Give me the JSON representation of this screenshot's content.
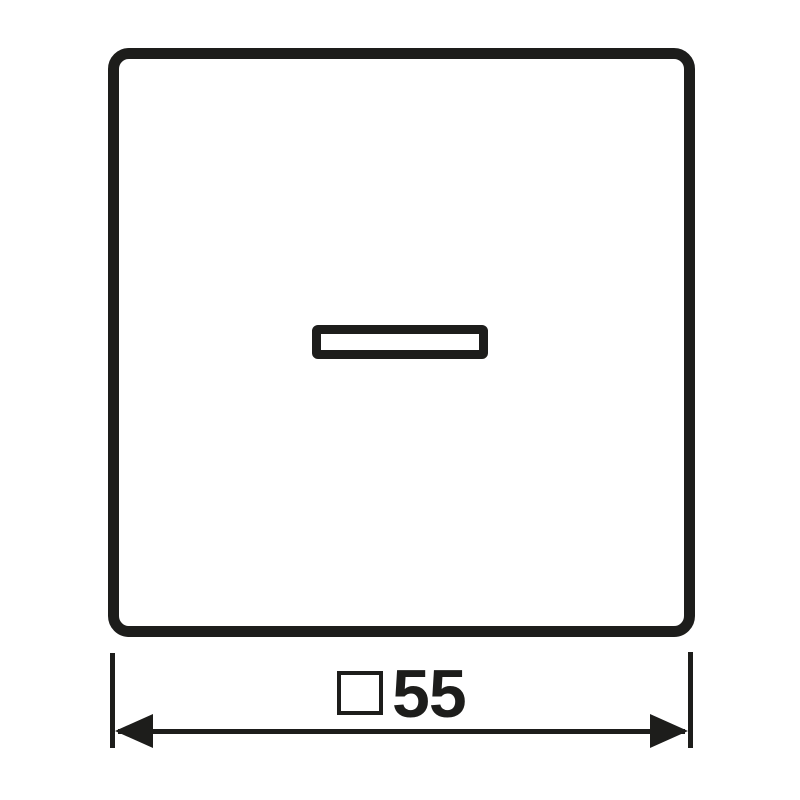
{
  "colors": {
    "stroke": "#1d1d1b",
    "background": "#ffffff"
  },
  "drawing": {
    "description": "Technical dimension drawing of a square switch rocker cover with indicator lens window",
    "dimension": {
      "symbol": "□",
      "symbol_icon": "square-dimension-icon",
      "value": "55",
      "label": "□55"
    }
  }
}
